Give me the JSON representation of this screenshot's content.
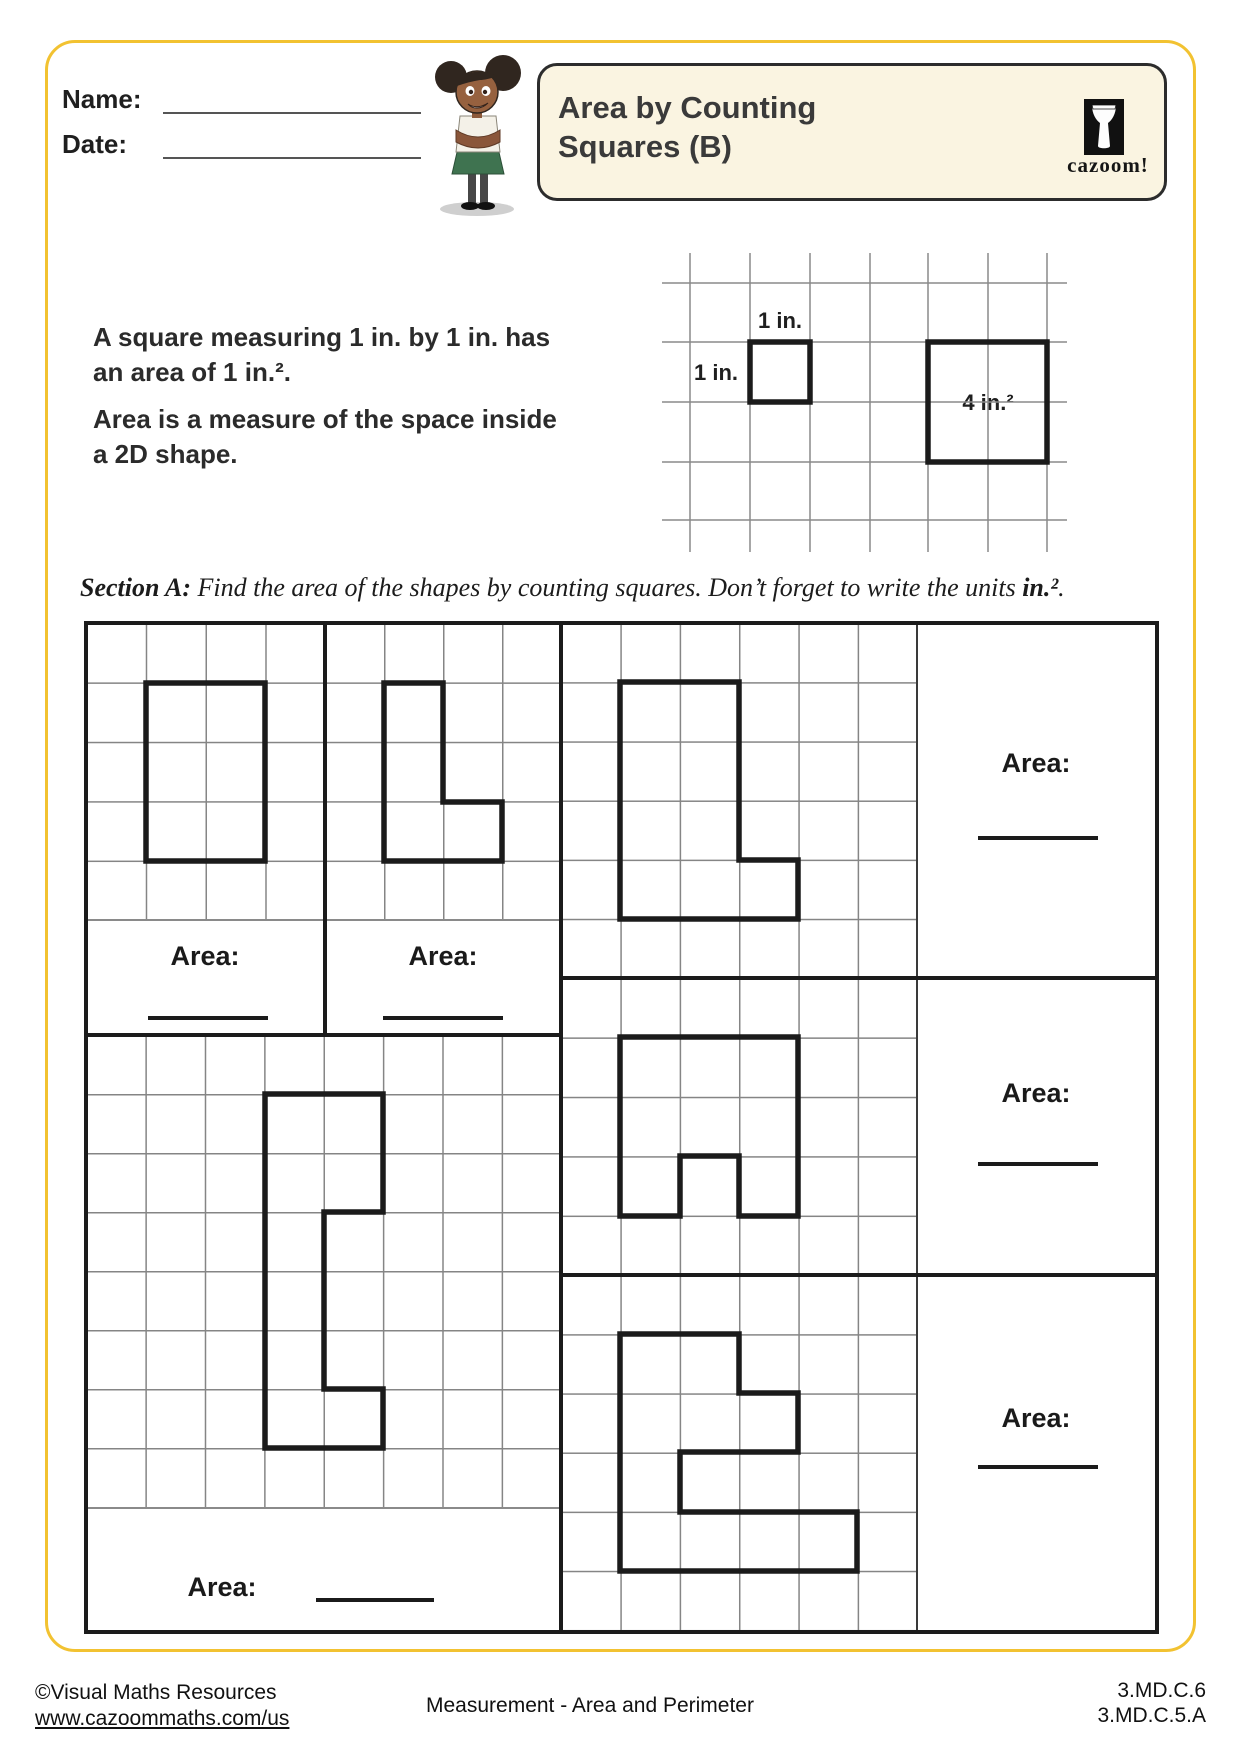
{
  "header": {
    "name_label": "Name:",
    "date_label": "Date:",
    "title_line1": "Area by Counting",
    "title_line2": "Squares (B)",
    "logo_text": "cazoom!"
  },
  "intro": {
    "para1_line1": "A square measuring 1 in. by 1 in. has",
    "para1_line2": "an area of 1 in.².",
    "para2_line1": "Area is a measure of the space inside",
    "para2_line2": "a 2D shape."
  },
  "example": {
    "label_top": "1 in.",
    "label_left": "1 in.",
    "label_big": "4 in.²"
  },
  "section_a": {
    "label": "Section A:",
    "instruction": " Find the area of the shapes by counting squares. Don’t forget to write the units ",
    "units": "in.²",
    "period": "."
  },
  "worksheet": {
    "area_labels": [
      "Area:",
      "Area:",
      "Area:",
      "Area:",
      "Area:",
      "Area:"
    ]
  },
  "footer": {
    "copyright": "©Visual Maths Resources",
    "url": "www.cazoommaths.com/us",
    "center": "Measurement - Area and Perimeter",
    "standard1": "3.MD.C.6",
    "standard2": "3.MD.C.5.A"
  }
}
